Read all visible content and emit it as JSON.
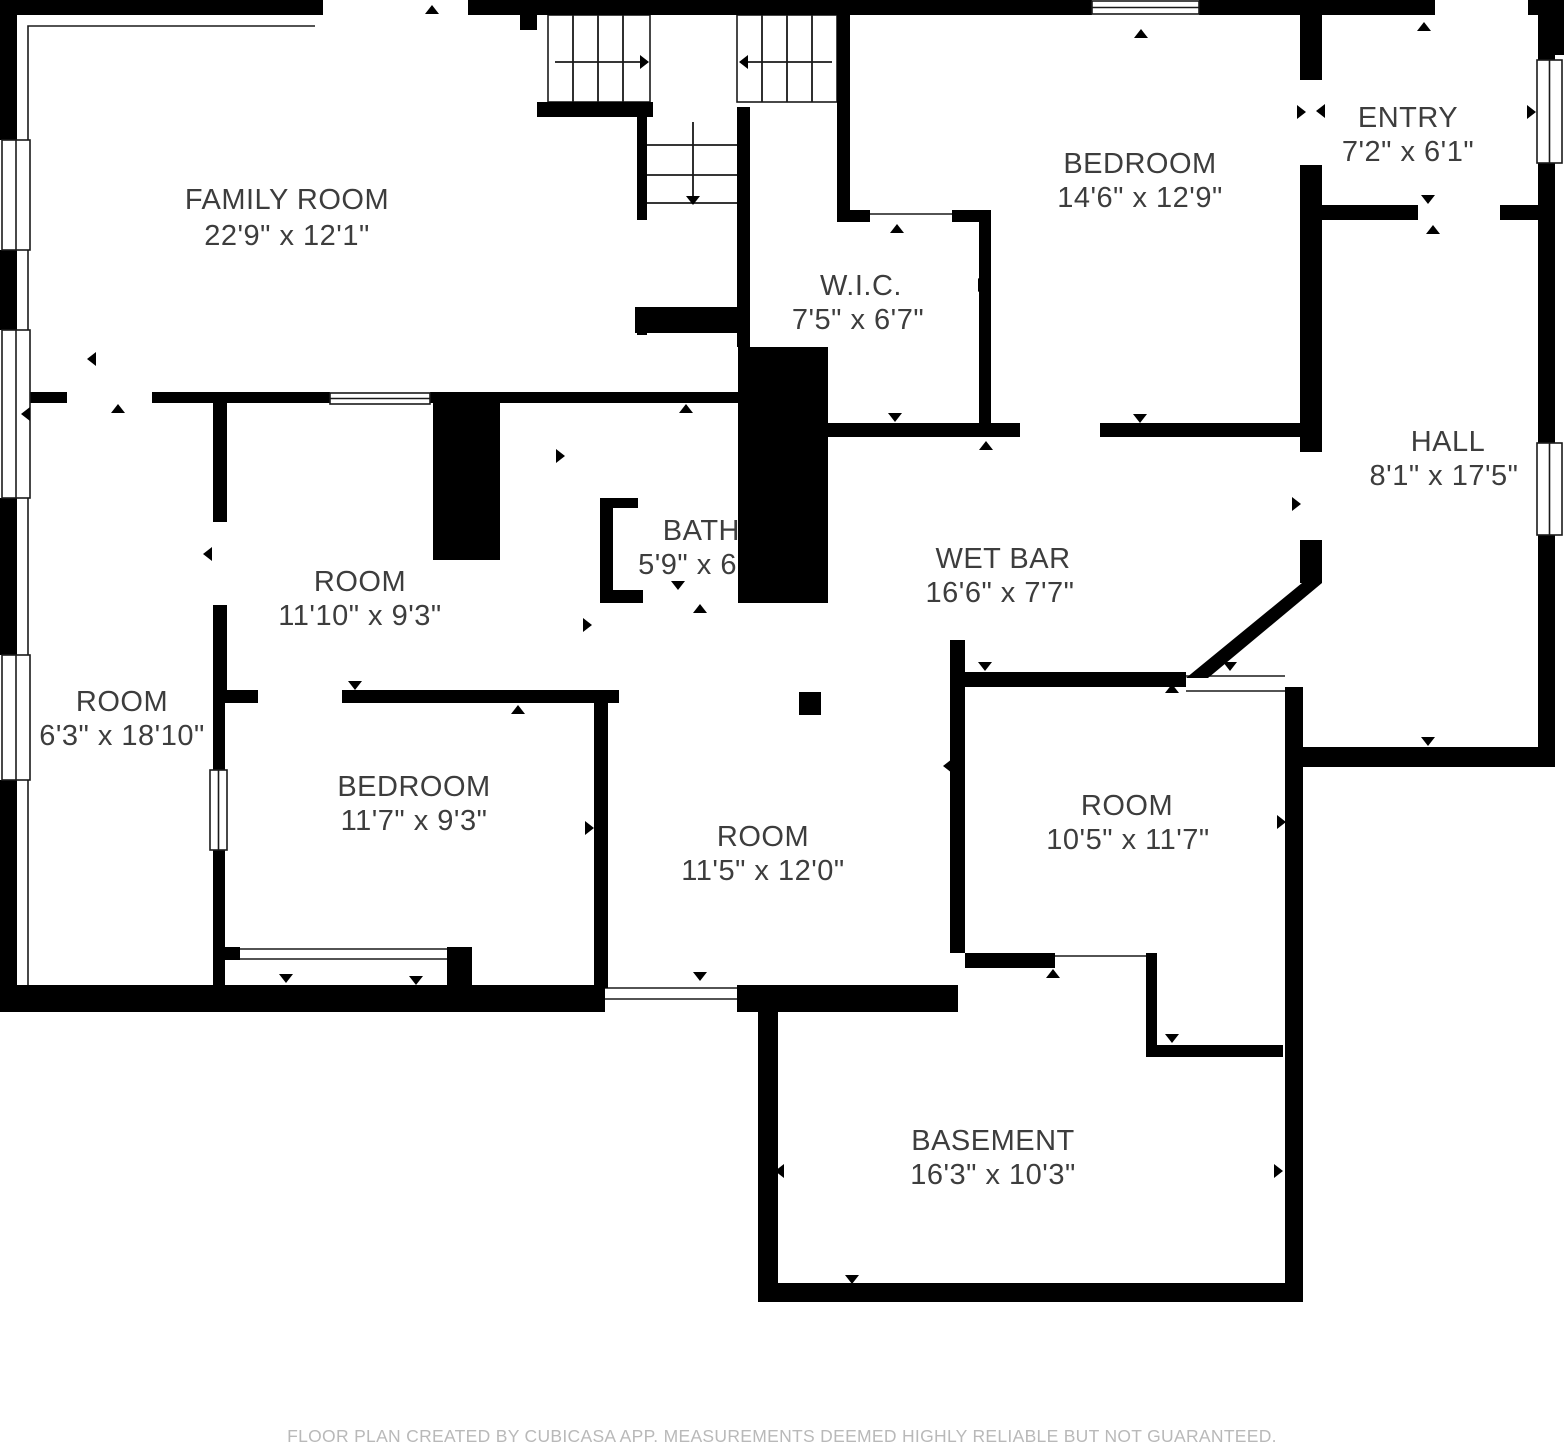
{
  "meta": {
    "app": "CubiCasa floor plan",
    "background_color": "#ffffff",
    "wall_color": "#000000",
    "label_color": "#3d3d3d",
    "footer_color": "#b9b9b9"
  },
  "rooms": [
    {
      "name": "FAMILY ROOM",
      "dims": "22'9\" x 12'1\""
    },
    {
      "name": "BEDROOM",
      "dims": "14'6\" x 12'9\""
    },
    {
      "name": "ENTRY",
      "dims": "7'2\" x 6'1\""
    },
    {
      "name": "W.I.C.",
      "dims": "7'5\" x 6'7\""
    },
    {
      "name": "HALL",
      "dims": "8'1\" x 17'5\""
    },
    {
      "name": "BATH",
      "dims": "5'9\" x 6'"
    },
    {
      "name": "WET BAR",
      "dims": "16'6\" x 7'7\""
    },
    {
      "name": "ROOM",
      "dims": "11'10\" x 9'3\""
    },
    {
      "name": "ROOM",
      "dims": "6'3\" x 18'10\""
    },
    {
      "name": "BEDROOM",
      "dims": "11'7\" x 9'3\""
    },
    {
      "name": "ROOM",
      "dims": "11'5\" x 12'0\""
    },
    {
      "name": "ROOM",
      "dims": "10'5\" x 11'7\""
    },
    {
      "name": "BASEMENT",
      "dims": "16'3\" x 10'3\""
    }
  ],
  "footer": {
    "text": "FLOOR PLAN CREATED BY CUBICASA APP. MEASUREMENTS DEEMED HIGHLY RELIABLE BUT NOT GUARANTEED."
  }
}
